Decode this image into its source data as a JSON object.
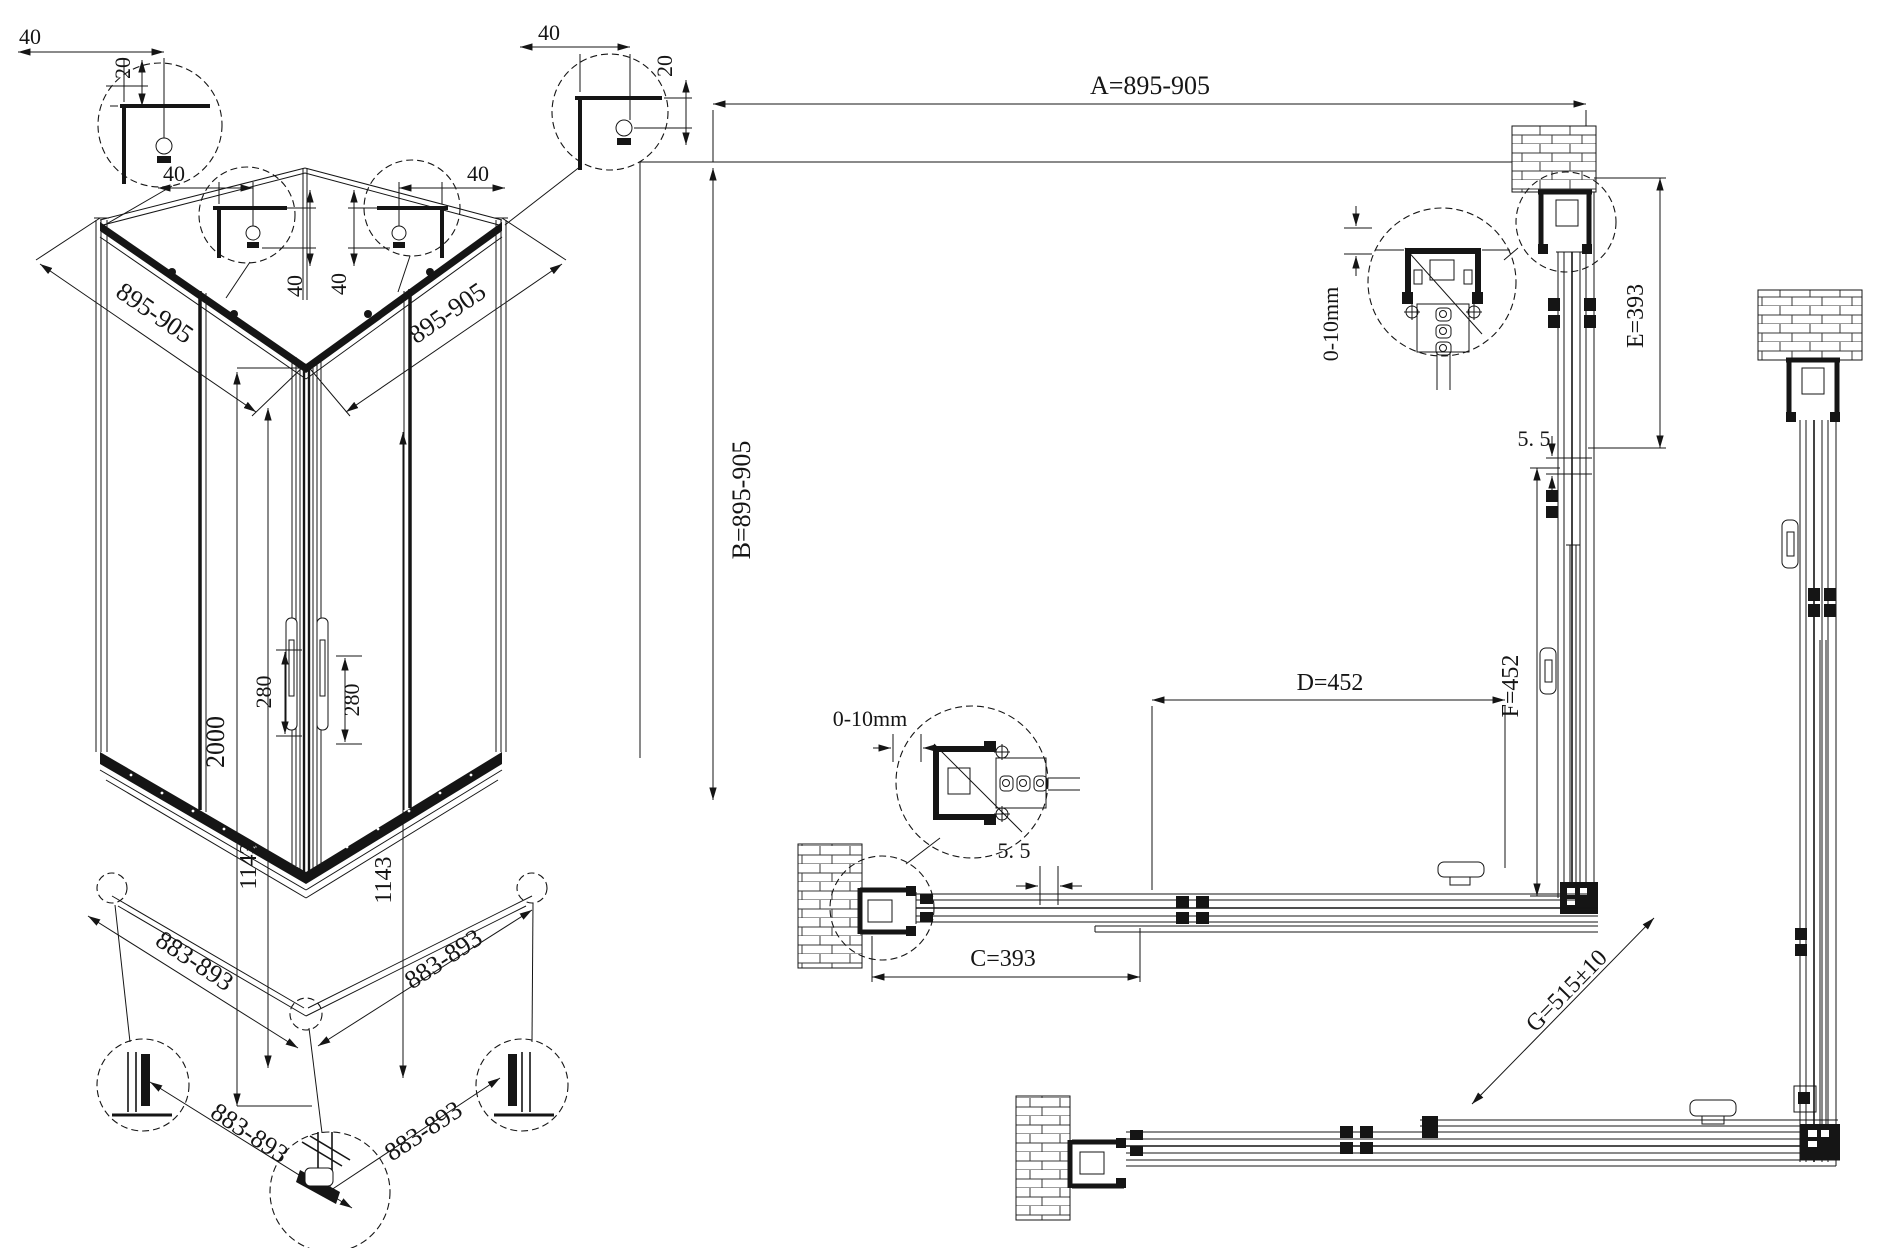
{
  "iso": {
    "width_left": "895-905",
    "width_right": "895-905",
    "height": "2000",
    "handle_left": "280",
    "handle_right": "280",
    "door_left": "1143",
    "door_right": "1143",
    "base_left": "883-893",
    "base_right": "883-893",
    "tray_left": "883-893",
    "tray_right": "883-893",
    "detail_tl_w": "40",
    "detail_tl_h": "20",
    "detail_tr_w": "40",
    "detail_tr_h": "20",
    "detail_ml_w": "40",
    "detail_ml_h": "40",
    "detail_mr_w": "40",
    "detail_mr_h": "40"
  },
  "plan": {
    "A": "A=895-905",
    "B": "B=895-905",
    "C": "C=393",
    "D": "D=452",
    "E": "E=393",
    "F": "F=452",
    "G": "G=515±10",
    "gap_top": "5. 5",
    "gap_bottom": "5. 5",
    "adjust_top": "0-10mm",
    "adjust_bottom": "0-10mm"
  },
  "colors": {
    "line": "#151515",
    "background": "#ffffff"
  }
}
